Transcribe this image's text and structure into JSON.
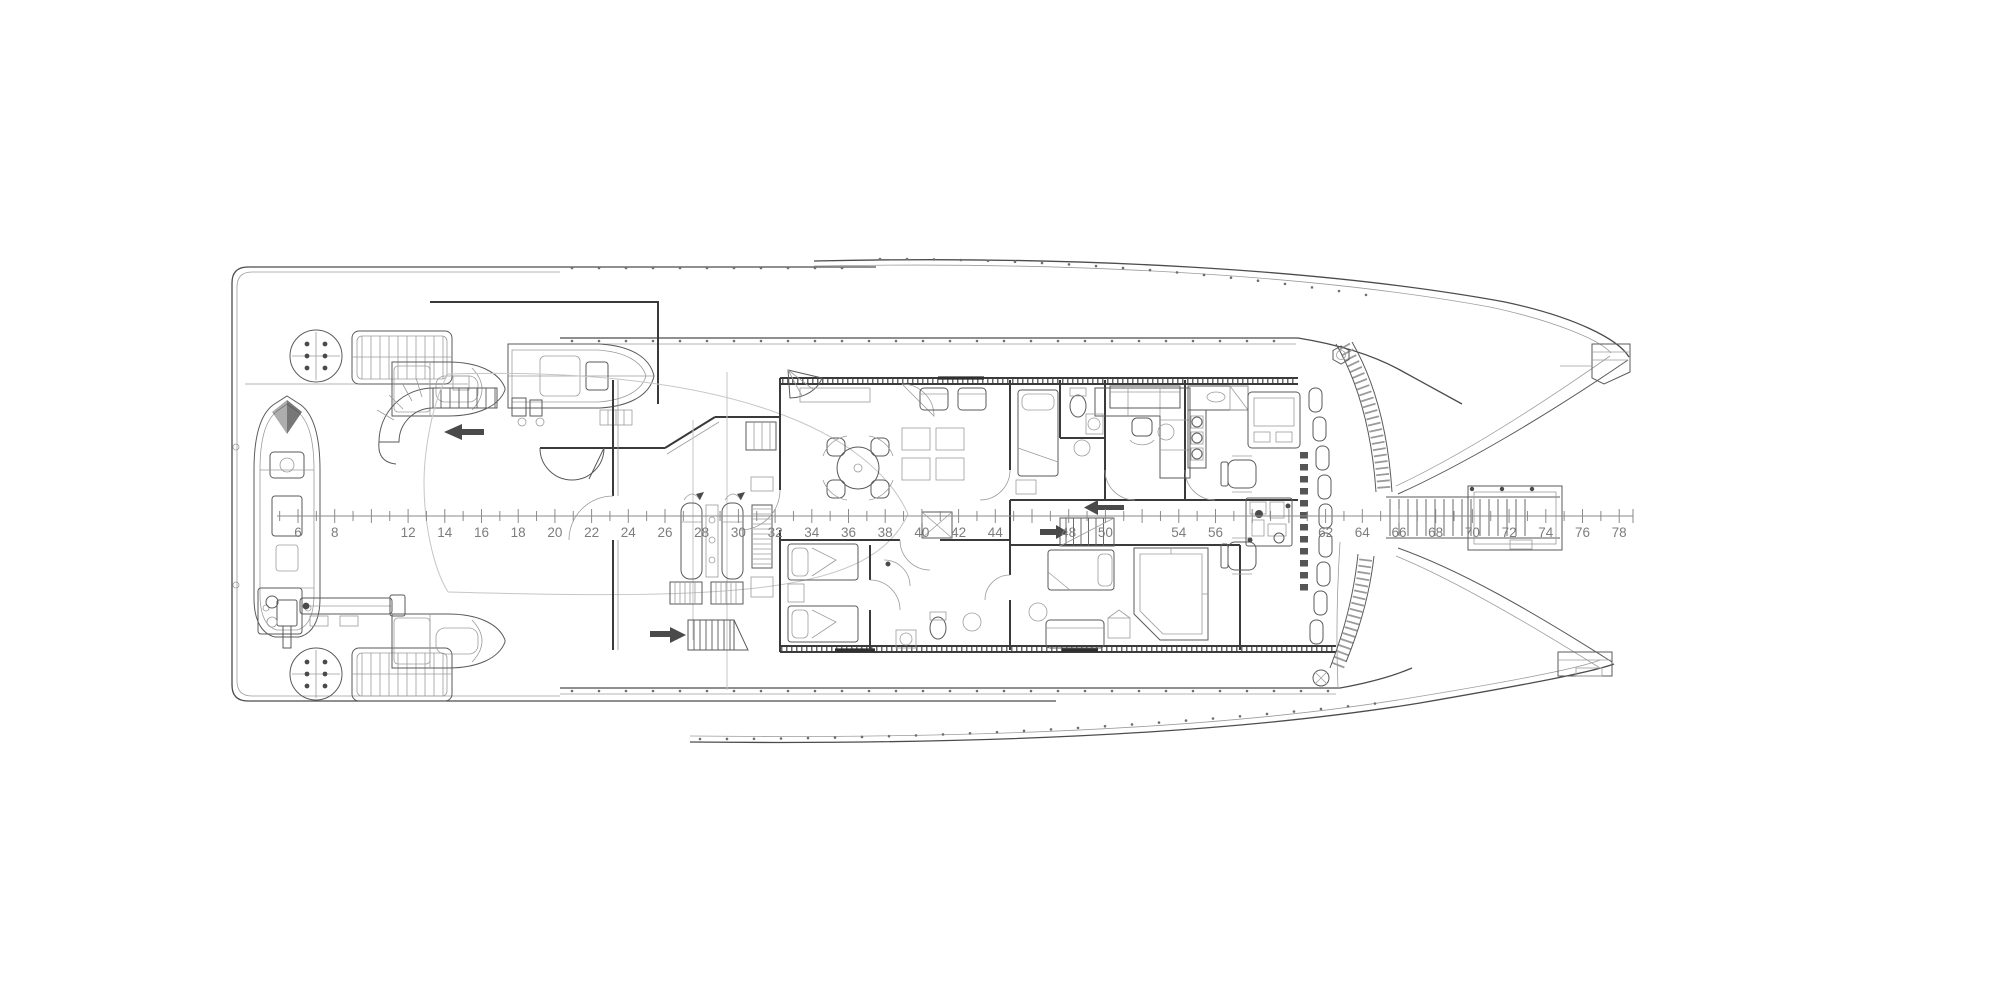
{
  "drawing": {
    "title": "catamaran-yacht-deck-general-arrangement-plan",
    "frame_ruler": {
      "visible_labels": [
        "6",
        "8",
        "12",
        "14",
        "16",
        "18",
        "20",
        "22",
        "24",
        "26",
        "28",
        "30",
        "32",
        "34",
        "36",
        "38",
        "40",
        "42",
        "44",
        "48",
        "50",
        "54",
        "56",
        "62",
        "64",
        "66",
        "68",
        "70",
        "72",
        "74",
        "76",
        "78"
      ],
      "first_frame": 6,
      "last_frame": 78,
      "label_color": "#7d7d7d"
    },
    "features": [
      {
        "name": "stern-platform"
      },
      {
        "name": "capstan-hatch-aft-port"
      },
      {
        "name": "capstan-hatch-aft-starboard"
      },
      {
        "name": "deck-grating-port"
      },
      {
        "name": "deck-grating-starboard"
      },
      {
        "name": "tender-rib-boat"
      },
      {
        "name": "deck-crane"
      },
      {
        "name": "watercraft-port"
      },
      {
        "name": "watercraft-starboard"
      },
      {
        "name": "tender-garage-with-boat"
      },
      {
        "name": "spiral-staircase"
      },
      {
        "name": "aft-entry-staircase"
      },
      {
        "name": "ghost-tender-outline"
      },
      {
        "name": "sun-loungers"
      },
      {
        "name": "deck-hatches"
      },
      {
        "name": "saloon-dining-table"
      },
      {
        "name": "saloon-lounge"
      },
      {
        "name": "guest-cabin-twin-beds"
      },
      {
        "name": "guest-cabin-bed"
      },
      {
        "name": "vip-cabin"
      },
      {
        "name": "bathrooms"
      },
      {
        "name": "office-desk"
      },
      {
        "name": "galley"
      },
      {
        "name": "helm-console"
      },
      {
        "name": "helm-chairs"
      },
      {
        "name": "corridor-staircase"
      },
      {
        "name": "windlass-machinery"
      },
      {
        "name": "windshield-panes"
      },
      {
        "name": "bow-gangway-ladder"
      },
      {
        "name": "port-hull-bow"
      },
      {
        "name": "starboard-hull-bow"
      }
    ],
    "colors": {
      "background": "#ffffff",
      "line": "#4c4c4c",
      "heavy_line": "#2e2e2e",
      "light_line": "#9c9c9c",
      "ghost_line": "#c6c6c6",
      "label": "#7d7d7d"
    }
  }
}
